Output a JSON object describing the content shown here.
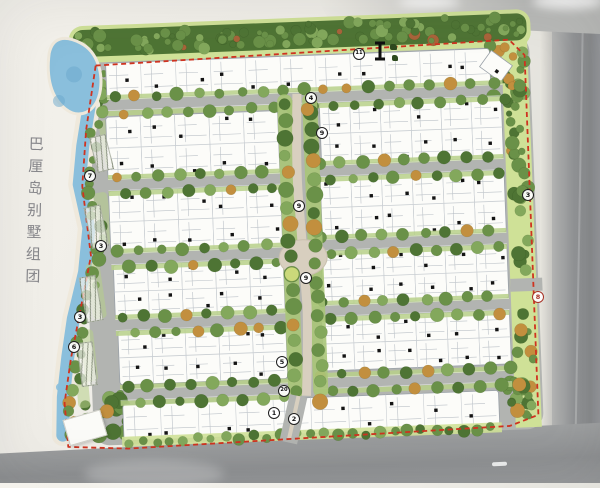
{
  "title": {
    "text": "巴厘岛别墅组团"
  },
  "plan_markers": [
    {
      "label": "11",
      "x": 359,
      "y": 54
    },
    {
      "label": "4",
      "x": 311,
      "y": 98
    },
    {
      "label": "9",
      "x": 322,
      "y": 133
    },
    {
      "label": "7",
      "x": 90,
      "y": 176
    },
    {
      "label": "3",
      "x": 528,
      "y": 195
    },
    {
      "label": "9",
      "x": 299,
      "y": 206
    },
    {
      "label": "3",
      "x": 101,
      "y": 246
    },
    {
      "label": "9",
      "x": 306,
      "y": 278
    },
    {
      "label": "8",
      "x": 538,
      "y": 297,
      "variant": "red"
    },
    {
      "label": "3",
      "x": 80,
      "y": 317
    },
    {
      "label": "6",
      "x": 74,
      "y": 347
    },
    {
      "label": "5",
      "x": 282,
      "y": 362
    },
    {
      "label": "20",
      "x": 284,
      "y": 391
    },
    {
      "label": "1",
      "x": 274,
      "y": 413
    },
    {
      "label": "2",
      "x": 294,
      "y": 419
    }
  ],
  "icons": {
    "section_cut": {
      "x": 372,
      "y": 41
    },
    "plant_legend": {
      "x": 390,
      "y": 44
    }
  },
  "colors": {
    "paper": "#f2f0ea",
    "water": "#8abfdc",
    "water_deep": "#6aa8cb",
    "sand": "#efe9dc",
    "forest_dark": "#4e7434",
    "forest_mid": "#6a9148",
    "forest_light": "#83a85c",
    "verge_light": "#cfe197",
    "verge_mid": "#b7d089",
    "tree_orange": "#c28f3e",
    "road_inner": "#b2b4b1",
    "road_outer": "#8f9193",
    "house_fill": "#fcfcf9",
    "house_stroke": "#9aa1a8",
    "black_marker": "#141414",
    "boundary_red": "#cf3320",
    "plaza_tan": "#d8cfbf",
    "title_grey": "#87878b"
  }
}
